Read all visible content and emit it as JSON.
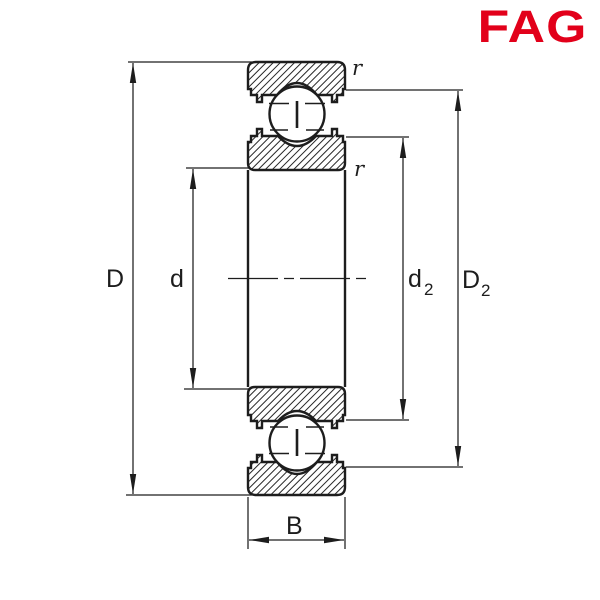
{
  "brand": {
    "name": "FAG",
    "logo_color": "#e2001a"
  },
  "drawing": {
    "description": "deep groove ball bearing cross-section",
    "labels": {
      "outer_diameter": "D",
      "bore_diameter": "d",
      "inner_shoulder_diameter_base": "d",
      "inner_shoulder_diameter_sub": "2",
      "outer_shoulder_diameter_base": "D",
      "outer_shoulder_diameter_sub": "2",
      "width": "B",
      "radius_top": "r",
      "radius_bottom": "r"
    },
    "colors": {
      "line": "#1d1d1d",
      "background": "#ffffff"
    }
  }
}
